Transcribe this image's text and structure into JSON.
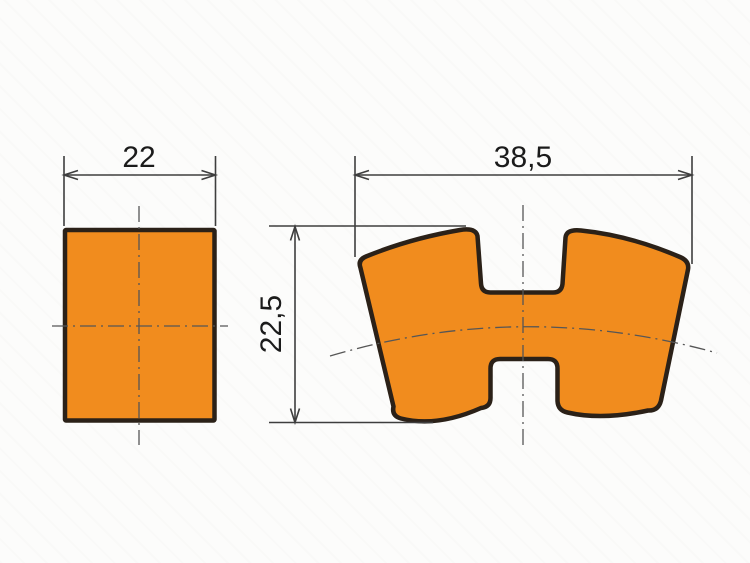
{
  "colors": {
    "background": "#fcfcfb",
    "part_fill": "#f18c1e",
    "part_outline": "#2b2118",
    "dimension_lines": "#3e3e3e",
    "centerlines": "#565656",
    "label_text": "#1b1b1b"
  },
  "views": {
    "side": {
      "width_label": "22"
    },
    "front": {
      "width_label": "38,5",
      "height_label": "22,5"
    }
  }
}
